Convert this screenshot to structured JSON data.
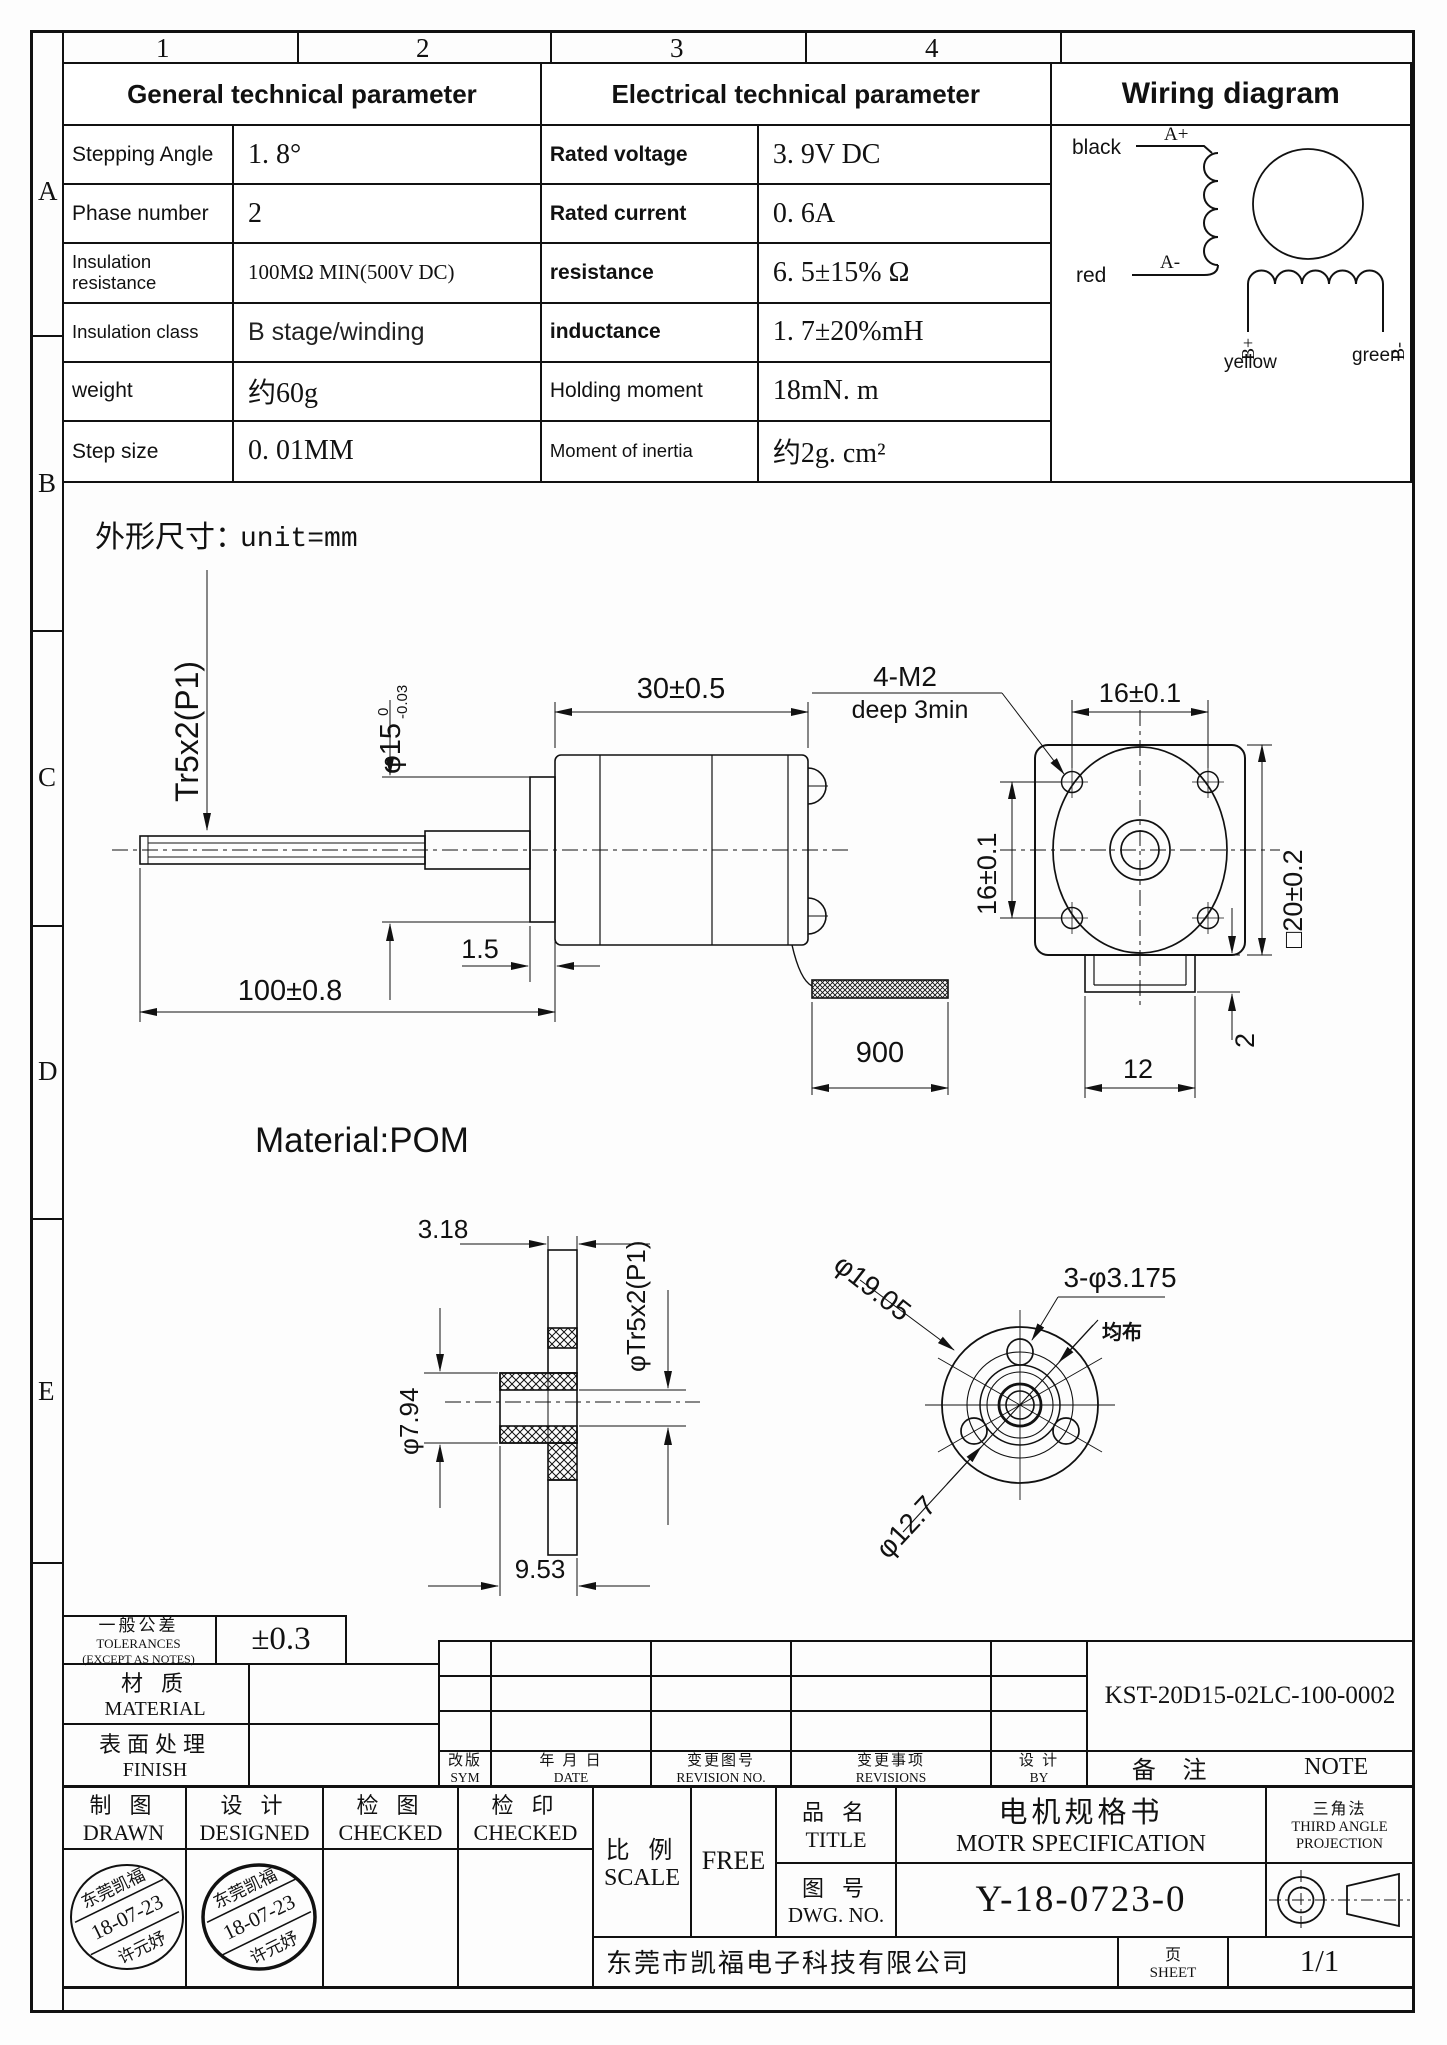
{
  "frame": {
    "cols": [
      "1",
      "2",
      "3",
      "4"
    ],
    "rows": [
      "A",
      "B",
      "C",
      "D",
      "E"
    ]
  },
  "general": {
    "title": "General technical parameter",
    "rows": [
      {
        "label": "Stepping Angle",
        "value": "1. 8°"
      },
      {
        "label": "Phase number",
        "value": "2"
      },
      {
        "label": "Insulation resistance",
        "value": "100MΩ MIN(500V DC)"
      },
      {
        "label": "Insulation class",
        "value": "B stage/winding"
      },
      {
        "label": "weight",
        "value": "约60g"
      },
      {
        "label": "Step size",
        "value": "0. 01MM"
      }
    ]
  },
  "electrical": {
    "title": "Electrical technical parameter",
    "rows": [
      {
        "label": "Rated voltage",
        "value": "3. 9V  DC"
      },
      {
        "label": "Rated current",
        "value": "0. 6A"
      },
      {
        "label": "resistance",
        "value": "6. 5±15% Ω"
      },
      {
        "label": "inductance",
        "value": "1. 7±20%mH"
      },
      {
        "label": "Holding moment",
        "value": "18mN. m"
      },
      {
        "label": "Moment of inertia",
        "value": "约2g. cm²"
      }
    ]
  },
  "wiring": {
    "title": "Wiring diagram",
    "black": "black",
    "red": "red",
    "a_plus": "A+",
    "a_minus": "A-",
    "b_plus": "B+",
    "b_minus": "B-",
    "yellow": "yellow",
    "green": "green"
  },
  "drawing": {
    "heading": "外形尺寸：",
    "unit": "unit=mm",
    "material": "Material:POM",
    "thread": "Tr5x2(P1)",
    "shaft_dia": "φ15",
    "tol_hi": "0",
    "tol_lo": "-0.03",
    "body_len": "30±0.5",
    "screw_note1": "4-M2",
    "screw_note2": "deep  3min",
    "flange_w": "16±0.1",
    "flange_h": "16±0.1",
    "square": "□20±0.2",
    "collar": "1.5",
    "shaft_len": "100±0.8",
    "cable_len": "900",
    "tab_w": "12",
    "tab_h": "2",
    "hub_w": "3.18",
    "gear_thread": "φTr5x2(P1)",
    "bore": "φ7.94",
    "hub_len": "9.53",
    "gear_od": "φ19.05",
    "holes": "3-φ3.175",
    "dist": "均布",
    "bolt_circle": "φ12.7"
  },
  "titleblock": {
    "tol_cn": "一般公差",
    "tol_en": "TOLERANCES",
    "tol_note": "(EXCEPT AS NOTES)",
    "tol_value": "±0.3",
    "material_cn": "材  质",
    "material_en": "MATERIAL",
    "finish_cn": "表面处理",
    "finish_en": "FINISH",
    "sym_cn": "改版",
    "sym_en": "SYM",
    "date_cn": "年 月 日",
    "date_en": "DATE",
    "revno_cn": "变更图号",
    "revno_en": "REVISION NO.",
    "revisions_cn": "变更事项",
    "revisions_en": "REVISIONS",
    "by_cn": "设  计",
    "by_en": "BY",
    "note_cn": "备  注",
    "note_en": "NOTE",
    "part_no": "KST-20D15-02LC-100-0002",
    "drawn_cn": "制  图",
    "drawn_en": "DRAWN",
    "designed_cn": "设  计",
    "designed_en": "DESIGNED",
    "checked1_cn": "检  图",
    "checked1_en": "CHECKED",
    "checked2_cn": "检  印",
    "checked2_en": "CHECKED",
    "scale_cn": "比  例",
    "scale_en": "SCALE",
    "scale_value": "FREE",
    "title_cn": "品  名",
    "title_en": "TITLE",
    "product_cn": "电机规格书",
    "product_en": "MOTR SPECIFICATION",
    "dwg_cn": "图  号",
    "dwg_en": "DWG. NO.",
    "dwg_no": "Y-18-0723-0",
    "proj_cn": "三角法",
    "proj_en1": "THIRD ANGLE",
    "proj_en2": "PROJECTION",
    "company": "东莞市凯福电子科技有限公司",
    "sheet_cn": "页",
    "sheet_en": "SHEET",
    "sheet_value": "1/1",
    "stamp_line1": "东莞凯福",
    "stamp_line2": "18-07-23",
    "stamp_line3": "许元妤"
  }
}
